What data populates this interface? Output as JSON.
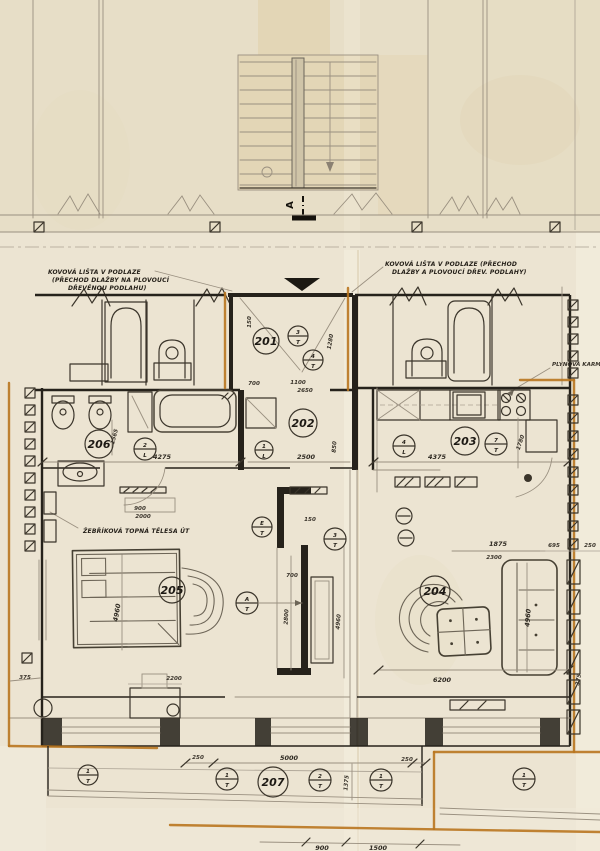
{
  "section_label": "A",
  "notes": {
    "left1": "KOVOVÁ LIŠTA V PODLAZE",
    "left2": "(PŘECHOD DLAŽBY NA PLOVOUCÍ",
    "left3": "DŘEVĚNOU PODLAHU)",
    "right1": "KOVOVÁ LIŠTA V PODLAZE (PŘECHOD",
    "right2": "DLAŽBY A PLOVOUCÍ DŘEV. PODLAHY)",
    "heating": "ŽEBŘÍKOVÁ TOPNÁ TĚLESA ÚT",
    "gas": "PLYNOVÁ KARMA"
  },
  "rooms": {
    "entry": "201",
    "hall": "202",
    "kitchen": "203",
    "living": "204",
    "bedroom": "205",
    "bathroom": "206",
    "balcony": "207"
  },
  "markers": {
    "entry_a": {
      "num": "3",
      "type": "T"
    },
    "entry_b": {
      "num": "4",
      "type": "T"
    },
    "bathroom": {
      "num": "2",
      "type": "L"
    },
    "hall": {
      "num": "1",
      "type": "L"
    },
    "kitchen_a": {
      "num": "4",
      "type": "L"
    },
    "kitchen_b": {
      "num": "7",
      "type": "T"
    },
    "chimney": {
      "num": "3",
      "type": "T"
    },
    "bedroom_e": {
      "num": "E",
      "type": "T"
    },
    "bedroom_a": {
      "num": "A",
      "type": "T"
    },
    "balcony_1": {
      "num": "1",
      "type": "T"
    },
    "balcony_2": {
      "num": "1",
      "type": "T"
    },
    "balcony_3": {
      "num": "2",
      "type": "T"
    },
    "balcony_4": {
      "num": "1",
      "type": "T"
    },
    "balcony_5": {
      "num": "1",
      "type": "T"
    }
  },
  "dims": {
    "entry_w": "150",
    "entry_h": "1280",
    "entry_d": "700",
    "hall_top_a": "1100",
    "hall_top_b": "2650",
    "bath_w": "4275",
    "bath_h": "1565",
    "hall_w": "2500",
    "hall_side": "850",
    "kitchen_w": "4375",
    "kitchen_d": "1780",
    "bed_top_a": "900",
    "bed_top_b": "2000",
    "core_top": "150",
    "core_w": "700",
    "core_h": "2800",
    "bedroom_h": "4960",
    "core_side": "4960",
    "living_h": "4960",
    "living_top_a": "1875",
    "living_top_b": "2300",
    "living_right_a": "695",
    "living_right_b": "250",
    "living_w": "6200",
    "desk_w": "2200",
    "left_off": "375",
    "right_off": "375",
    "balc_l": "250",
    "balc_w": "5000",
    "balc_r": "250",
    "balc_d": "1375",
    "bottom_a": "900",
    "bottom_b": "1500"
  }
}
